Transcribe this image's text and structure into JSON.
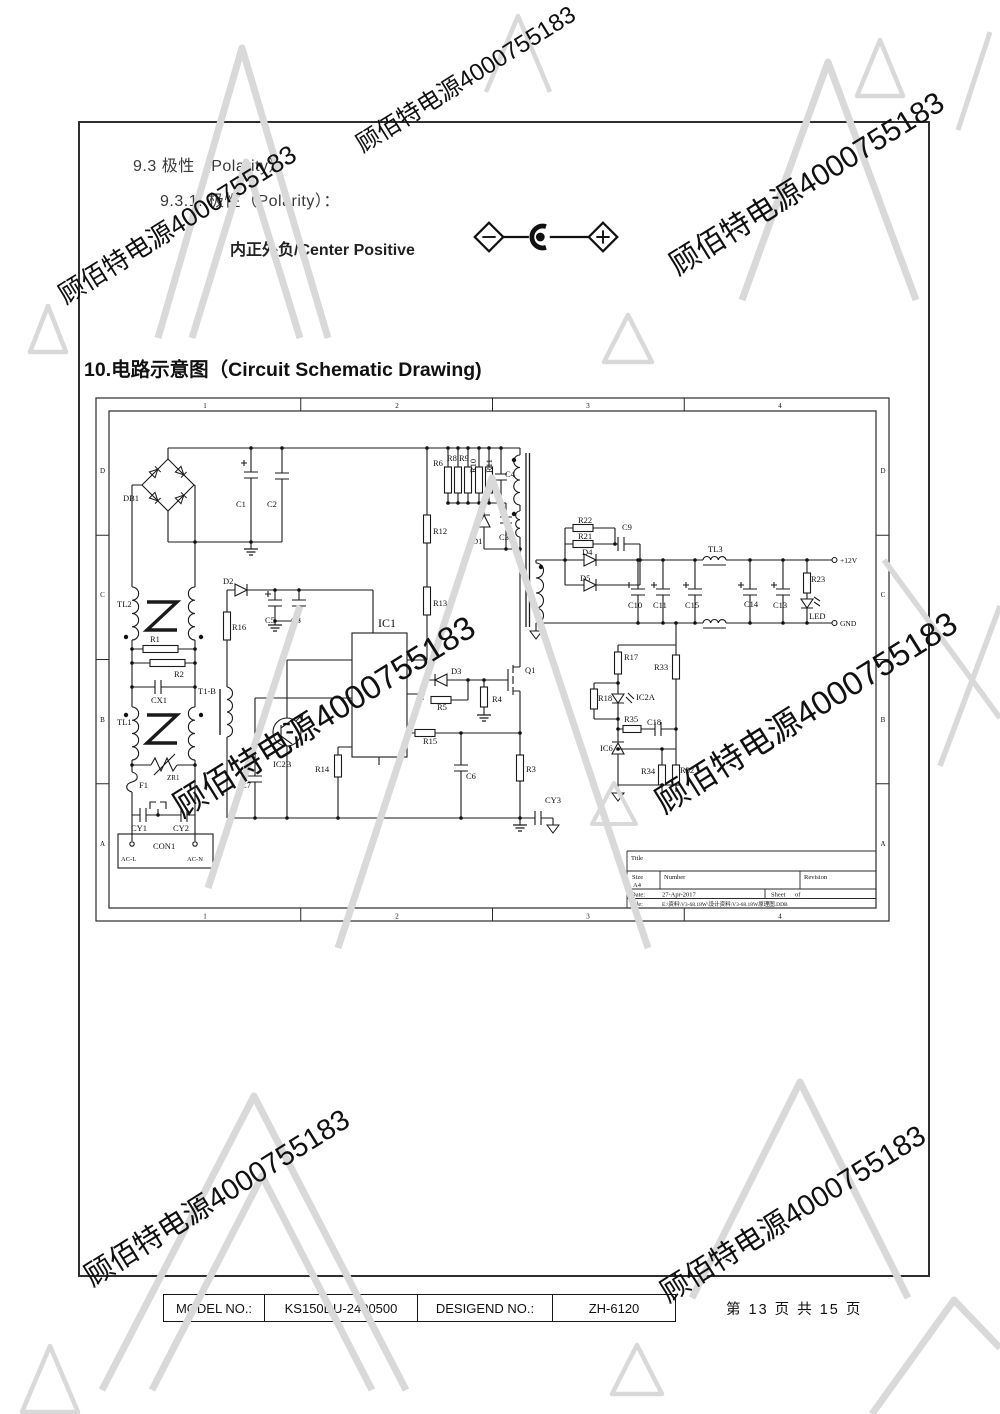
{
  "page": {
    "section_9_3": "9.3 极性（Polarity）",
    "section_9_3_1": "9.3.1.  极性（Polarity）：",
    "polarity_text": "内正外负/Center Positive",
    "section_10": "10.电路示意图（Circuit Schematic Drawing)",
    "page_info": "第 13 页 共 15 页"
  },
  "footer": {
    "cells": [
      "MODEL NO.:",
      "KS150DU-2400500",
      "DESIGEND NO.:",
      "ZH-6120"
    ]
  },
  "watermark": {
    "text": "顾佰特电源4000755183",
    "color": "#c9c9c9",
    "triangle_color": "#d9d9d9",
    "instances": [
      {
        "x": 812,
        "y": 192,
        "s": 30,
        "r": -32
      },
      {
        "x": 182,
        "y": 232,
        "s": 26,
        "r": -32
      },
      {
        "x": 470,
        "y": 86,
        "s": 24,
        "r": -32
      },
      {
        "x": 330,
        "y": 726,
        "s": 33,
        "r": -32
      },
      {
        "x": 812,
        "y": 722,
        "s": 33,
        "r": -32
      },
      {
        "x": 222,
        "y": 1206,
        "s": 29,
        "r": -32
      },
      {
        "x": 798,
        "y": 1222,
        "s": 29,
        "r": -32
      }
    ]
  },
  "schematic": {
    "border_columns": [
      "1",
      "2",
      "3",
      "4"
    ],
    "border_rows": [
      "D",
      "C",
      "B",
      "A"
    ],
    "labels": [
      {
        "t": "DB1",
        "x": 28,
        "y": 104
      },
      {
        "t": "C1",
        "x": 141,
        "y": 110
      },
      {
        "t": "C2",
        "x": 172,
        "y": 110
      },
      {
        "t": "TL2",
        "x": 22,
        "y": 210
      },
      {
        "t": "R1",
        "x": 55,
        "y": 245
      },
      {
        "t": "R2",
        "x": 79,
        "y": 280
      },
      {
        "t": "CX1",
        "x": 56,
        "y": 306
      },
      {
        "t": "TL1",
        "x": 22,
        "y": 328
      },
      {
        "t": "ZR1",
        "x": 72,
        "y": 383,
        "s": 7
      },
      {
        "t": "F1",
        "x": 44,
        "y": 391
      },
      {
        "t": "CY1",
        "x": 36,
        "y": 434
      },
      {
        "t": "CY2",
        "x": 78,
        "y": 434
      },
      {
        "t": "CON1",
        "x": 58,
        "y": 452
      },
      {
        "t": "AC-L",
        "x": 26,
        "y": 464,
        "s": 6.5
      },
      {
        "t": "AC-N",
        "x": 92,
        "y": 464,
        "s": 6.5
      },
      {
        "t": "D2",
        "x": 128,
        "y": 187
      },
      {
        "t": "C5",
        "x": 170,
        "y": 226
      },
      {
        "t": "C8",
        "x": 196,
        "y": 226
      },
      {
        "t": "R16",
        "x": 137,
        "y": 233
      },
      {
        "t": "T1-B",
        "x": 103,
        "y": 297
      },
      {
        "t": "C7",
        "x": 146,
        "y": 391
      },
      {
        "t": "IC2B",
        "x": 178,
        "y": 370
      },
      {
        "t": "R14",
        "x": 220,
        "y": 375
      },
      {
        "t": "IC1",
        "x": 283,
        "y": 230,
        "s": 12
      },
      {
        "t": "R12",
        "x": 338,
        "y": 137
      },
      {
        "t": "R13",
        "x": 338,
        "y": 209
      },
      {
        "t": "R6",
        "x": 338,
        "y": 69
      },
      {
        "t": "R8",
        "x": 352,
        "y": 64
      },
      {
        "t": "R9",
        "x": 364,
        "y": 64
      },
      {
        "t": "R10",
        "x": 381,
        "y": 76,
        "r": -90
      },
      {
        "t": "R11",
        "x": 397,
        "y": 76,
        "r": -90
      },
      {
        "t": "C4",
        "x": 410,
        "y": 80
      },
      {
        "t": "D1",
        "x": 377,
        "y": 147
      },
      {
        "t": "C3",
        "x": 404,
        "y": 143
      },
      {
        "t": "D3",
        "x": 356,
        "y": 277
      },
      {
        "t": "R5",
        "x": 342,
        "y": 313
      },
      {
        "t": "R4",
        "x": 397,
        "y": 305
      },
      {
        "t": "Q1",
        "x": 430,
        "y": 276
      },
      {
        "t": "R15",
        "x": 328,
        "y": 347
      },
      {
        "t": "C6",
        "x": 371,
        "y": 382
      },
      {
        "t": "R3",
        "x": 431,
        "y": 375
      },
      {
        "t": "CY3",
        "x": 450,
        "y": 406
      },
      {
        "t": "R22",
        "x": 483,
        "y": 126
      },
      {
        "t": "R21",
        "x": 483,
        "y": 142
      },
      {
        "t": "C9",
        "x": 527,
        "y": 133
      },
      {
        "t": "D4",
        "x": 487,
        "y": 158
      },
      {
        "t": "D5",
        "x": 485,
        "y": 184
      },
      {
        "t": "C10",
        "x": 533,
        "y": 211
      },
      {
        "t": "C11",
        "x": 558,
        "y": 211
      },
      {
        "t": "C15",
        "x": 590,
        "y": 211
      },
      {
        "t": "TL3",
        "x": 613,
        "y": 155
      },
      {
        "t": "C14",
        "x": 649,
        "y": 210
      },
      {
        "t": "C13",
        "x": 678,
        "y": 211
      },
      {
        "t": "R23",
        "x": 716,
        "y": 185
      },
      {
        "t": "LED",
        "x": 714,
        "y": 222
      },
      {
        "t": "+12V",
        "x": 745,
        "y": 166,
        "s": 7.5
      },
      {
        "t": "GND",
        "x": 745,
        "y": 229,
        "s": 7.5
      },
      {
        "t": "R17",
        "x": 529,
        "y": 263
      },
      {
        "t": "R33",
        "x": 559,
        "y": 273
      },
      {
        "t": "R18",
        "x": 503,
        "y": 304
      },
      {
        "t": "IC2A",
        "x": 541,
        "y": 303
      },
      {
        "t": "R35",
        "x": 529,
        "y": 325
      },
      {
        "t": "C18",
        "x": 552,
        "y": 328
      },
      {
        "t": "IC6",
        "x": 505,
        "y": 354
      },
      {
        "t": "R34",
        "x": 546,
        "y": 377
      },
      {
        "t": "R32",
        "x": 585,
        "y": 376
      },
      {
        "t": "Title",
        "x": 536,
        "y": 463,
        "s": 6.5
      },
      {
        "t": "Size",
        "x": 537,
        "y": 482,
        "s": 6.5
      },
      {
        "t": "A4",
        "x": 538,
        "y": 490,
        "s": 6.5
      },
      {
        "t": "Number",
        "x": 569,
        "y": 482,
        "s": 6.5
      },
      {
        "t": "Revision",
        "x": 709,
        "y": 482,
        "s": 6.5
      },
      {
        "t": "Date:",
        "x": 536,
        "y": 499.5,
        "s": 6.5
      },
      {
        "t": "27-Apr-2017",
        "x": 567,
        "y": 499.5,
        "s": 6.5
      },
      {
        "t": "Sheet",
        "x": 676,
        "y": 499.5,
        "s": 6.5
      },
      {
        "t": "of",
        "x": 700,
        "y": 499.5,
        "s": 6.5
      },
      {
        "t": "File:",
        "x": 536,
        "y": 509,
        "s": 6.5
      },
      {
        "t": "E:\\资料\\V3-68.18W\\设计资料\\V3-68.18W原理图.DDB",
        "x": 567,
        "y": 509,
        "s": 5.5
      }
    ]
  }
}
